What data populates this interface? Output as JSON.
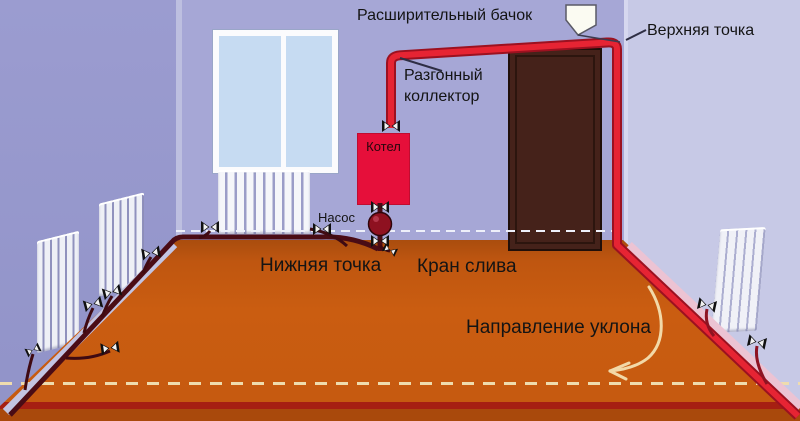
{
  "diagram": {
    "labels": {
      "expansion_tank": "Расширительный бачок",
      "top_point": "Верхняя точка",
      "accelerating_collector": "Разгонный коллектор",
      "boiler": "Котел",
      "pump": "Насос",
      "bottom_point": "Нижняя точка",
      "drain_valve": "Кран слива",
      "slope_direction": "Направление уклона"
    },
    "colors": {
      "wall_left": "#9a9bce",
      "wall_back": "#a6a7d6",
      "wall_right": "#c7c9e6",
      "floor": "#c65a10",
      "floor_bottom_band": "#a61f12",
      "pipe_hot": "#e62433",
      "pipe_hot_outline": "#9c1120",
      "pipe_return": "#4a0c15",
      "boiler": "#e60f3a",
      "door": "#45221a",
      "window_pane": "#c6dbf2",
      "radiator": "#f5f6fa",
      "slope_arrow": "#f2d9a8"
    }
  }
}
